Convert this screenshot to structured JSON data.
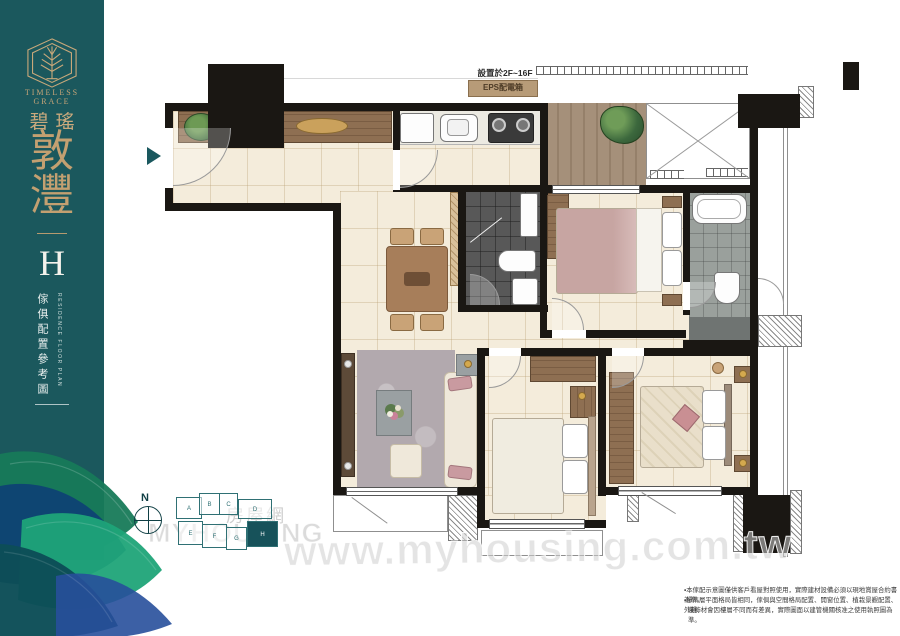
{
  "colors": {
    "sidebar_teal": "#1b585d",
    "brand_gold": "#c6a478",
    "wall_black": "#1a1713",
    "floor_cream": "#f4ecdb",
    "wood_brown": "#8a6a4e",
    "dark_tile_gray": "#585858",
    "accent_teal": "#1a585e",
    "watermark_gray": "#c8c8c8"
  },
  "sidebar": {
    "brand_en_line1": "TIMELESS",
    "brand_en_line2": "GRACE",
    "brand_zh": "碧瑤",
    "name_char1": "敦",
    "name_char2": "灃",
    "unit_label": "H",
    "caption_zh": "傢俱配置參考圖",
    "caption_en": "RESIDENCE FLOOR PLAN"
  },
  "plan": {
    "floor_note": "設置於2F~16F",
    "eps_label": "EPS配電箱",
    "compass_label": "N"
  },
  "keyplan": {
    "units": [
      "A",
      "B",
      "C",
      "D",
      "E",
      "F",
      "G",
      "H"
    ],
    "highlighted_unit": "H"
  },
  "watermark": {
    "site_url": "www.myhousing.com.tw",
    "logo_zh": "房屋網",
    "logo_en": "MYHOUSING"
  },
  "disclaimer": {
    "line1": "▪本傢配示意圖僅供客戶看屋對照使用，實際建材設備必須以現地賞屋合約書為準。",
    "line2": "▪標準層平面格局皆相同，傢俱與空間格局配置、開窗位置、植栽景觀配置、外觀、",
    "line3": "裝飾材會因樓層不同而有差異，實際圖面以建管機關核准之使用執照圖為準。"
  }
}
